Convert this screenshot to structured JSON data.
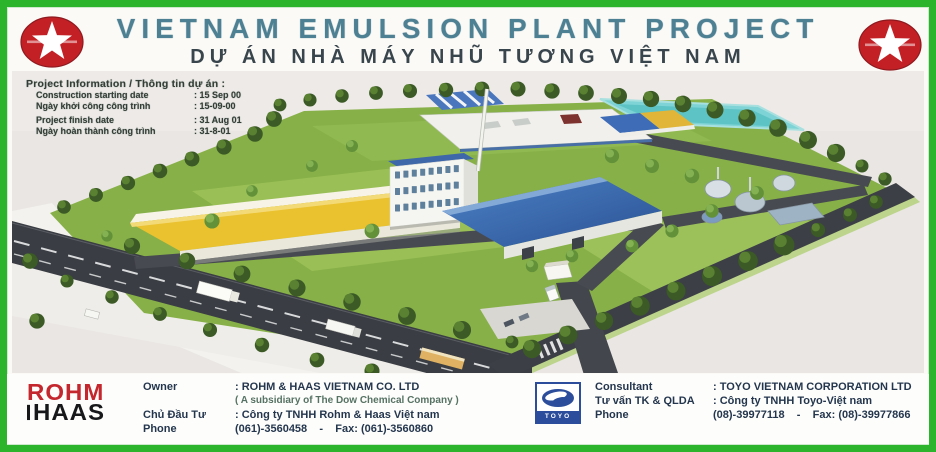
{
  "palette": {
    "frame_green": "#2cb52c",
    "star_red": "#c32026",
    "title_teal": "#4e8093",
    "rohm_red": "#c4272e",
    "toyo_navy": "#2b4d9b",
    "roof_blue": "#3f6cb5",
    "roof_yellow": "#e9c133",
    "pond_teal": "#7fd2d4",
    "grass_green": "#88b04b"
  },
  "header": {
    "title": "VIETNAM EMULSION PLANT PROJECT",
    "title_vi": "DỰ ÁN NHÀ MÁY NHŨ TƯƠNG VIỆT NAM",
    "location": "LOCATION: NHON TRACH 3 INDUSTRIAL ZONE - DONG NAI"
  },
  "project_info": {
    "heading": "Project Information / Thông tin dự án :",
    "rows": [
      {
        "label": "Construction starting date",
        "value": ": 15 Sep 00"
      },
      {
        "label": "Ngày khởi công công trình",
        "value": ": 15-09-00"
      },
      {
        "label": "Project finish date",
        "value": ": 31 Aug 01"
      },
      {
        "label": "Ngày hoàn thành công trình",
        "value": ": 31-8-01"
      }
    ]
  },
  "footer": {
    "rohm_logo": {
      "top": "ROHM",
      "bottom": "HAAS"
    },
    "owner_rows": [
      {
        "label": "Owner",
        "value": ": ROHM & HAAS VIETNAM CO. LTD"
      },
      {
        "label": "",
        "value": "( A subsidiary of The Dow Chemical Company )"
      },
      {
        "label": "Chủ Đầu Tư",
        "value": ": Công ty TNHH Rohm & Haas Việt nam"
      },
      {
        "label": "Phone",
        "value": "(061)-3560458    -    Fax: (061)-3560860"
      }
    ],
    "toyo_logo": {
      "text": "TOYO"
    },
    "consultant_rows": [
      {
        "label": "Consultant",
        "value": ": TOYO VIETNAM CORPORATION LTD"
      },
      {
        "label": "Tư vấn TK & QLDA",
        "value": ": Công ty TNHH Toyo-Việt nam"
      },
      {
        "label": "Phone",
        "value": "(08)-39977118    -    Fax: (08)-39977866"
      }
    ]
  }
}
